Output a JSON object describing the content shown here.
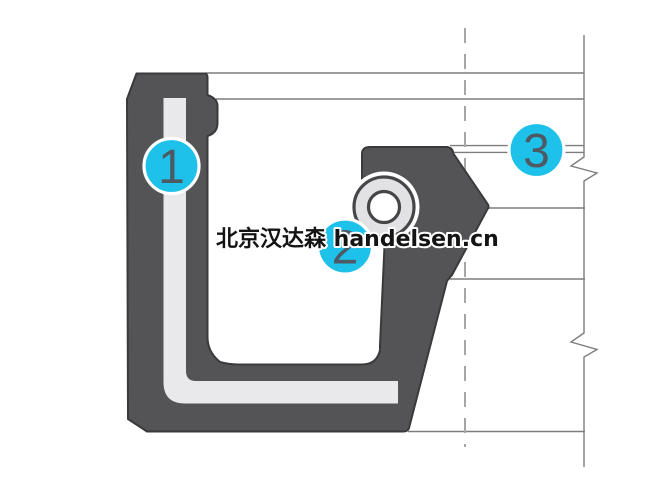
{
  "diagram": {
    "type": "shaft-seal-cross-section",
    "watermark": "北京汉达森 handelsen.cn",
    "callouts": [
      {
        "number": "1"
      },
      {
        "number": "2"
      },
      {
        "number": "3"
      }
    ],
    "colors": {
      "accent_cyan": "#1ec1e9",
      "seal_body": "#545456",
      "seal_outline": "#3a3a3c",
      "metal_insert": "#e9e9eb",
      "spring_ring": "#e2e2e4",
      "drawing_line": "#7d7d7d",
      "centerline": "#a6a6a6",
      "callout_number": "#4d5a64",
      "watermark_text": "#141414"
    }
  }
}
